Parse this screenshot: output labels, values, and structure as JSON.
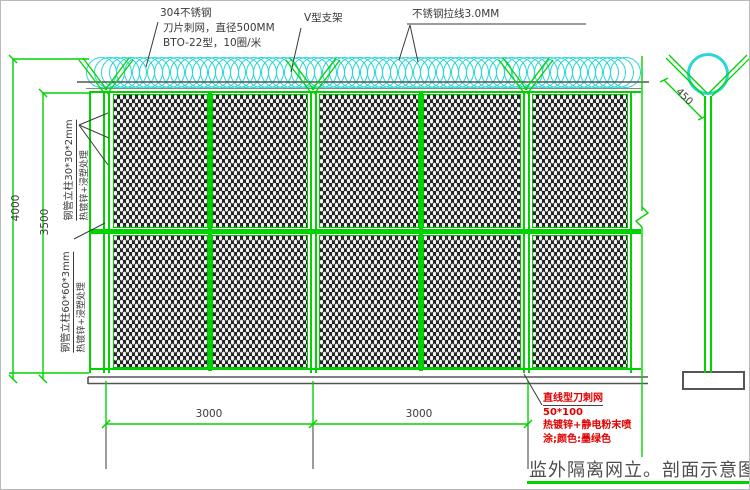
{
  "title_block": {
    "title": "监外隔离网立。剖面示意图"
  },
  "annotations": {
    "razor_coil": {
      "line1": "304不锈钢",
      "line2": "刀片刺网，直径500MM",
      "line3": "BTO-22型，10圈/米"
    },
    "v_bracket_label": "V型支架",
    "tension_wire_label": "不锈钢拉线3.0MM",
    "inner_post": {
      "line1": "钢管立柱30*30*2mm",
      "line2": "热镀锌+浸塑处理"
    },
    "main_post": {
      "line1": "钢管立柱60*60*3mm",
      "line2": "热镀锌+浸塑处理"
    },
    "mesh_spec": {
      "line1": "直线型刀刺网",
      "line2": "50*100",
      "line3": "热镀锌+静电粉末喷",
      "line4": "涂;颜色:墨绿色"
    }
  },
  "dimensions": {
    "overall_height": "4000",
    "mesh_height": "3500",
    "bay_width_1": "3000",
    "bay_width_2": "3000",
    "coil_bracket_width": "450"
  },
  "colors": {
    "structure_green": "#00d400",
    "coil_cyan": "#2bd6d6",
    "spec_text_red": "#e00000",
    "drawing_gray": "#4d4d4d"
  }
}
